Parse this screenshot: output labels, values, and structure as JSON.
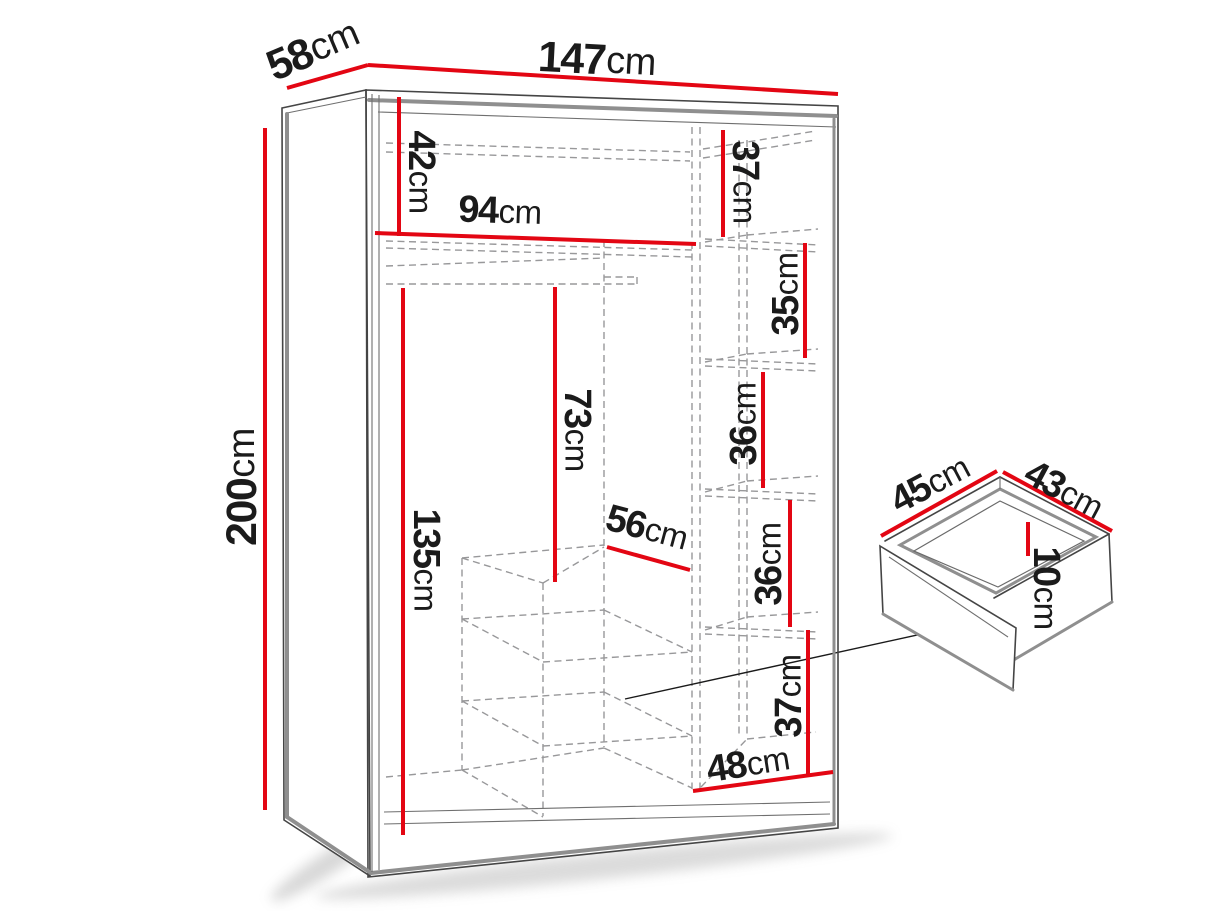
{
  "colors": {
    "dimension_line": "#e30613",
    "text": "#1b1b1b",
    "furniture_edge": "#454545",
    "furniture_rail": "#8f8f8f",
    "hidden_line_dashed": "#98989a",
    "background": "#ffffff"
  },
  "diagram": {
    "wardrobe": {
      "overall": {
        "width": {
          "value": "147",
          "unit": "cm"
        },
        "depth": {
          "value": "58",
          "unit": "cm"
        },
        "height": {
          "value": "200",
          "unit": "cm"
        }
      },
      "interior": {
        "top_left_height": {
          "value": "42",
          "unit": "cm"
        },
        "left_width": {
          "value": "94",
          "unit": "cm"
        },
        "hanging_height": {
          "value": "135",
          "unit": "cm"
        },
        "middle_height": {
          "value": "73",
          "unit": "cm"
        },
        "middle_width": {
          "value": "56",
          "unit": "cm"
        },
        "right_column": [
          {
            "value": "37",
            "unit": "cm"
          },
          {
            "value": "35",
            "unit": "cm"
          },
          {
            "value": "36",
            "unit": "cm"
          },
          {
            "value": "36",
            "unit": "cm"
          },
          {
            "value": "37",
            "unit": "cm"
          }
        ],
        "right_width": {
          "value": "48",
          "unit": "cm"
        }
      }
    },
    "drawer_detail": {
      "width": {
        "value": "45",
        "unit": "cm"
      },
      "depth": {
        "value": "43",
        "unit": "cm"
      },
      "height": {
        "value": "10",
        "unit": "cm"
      }
    }
  }
}
